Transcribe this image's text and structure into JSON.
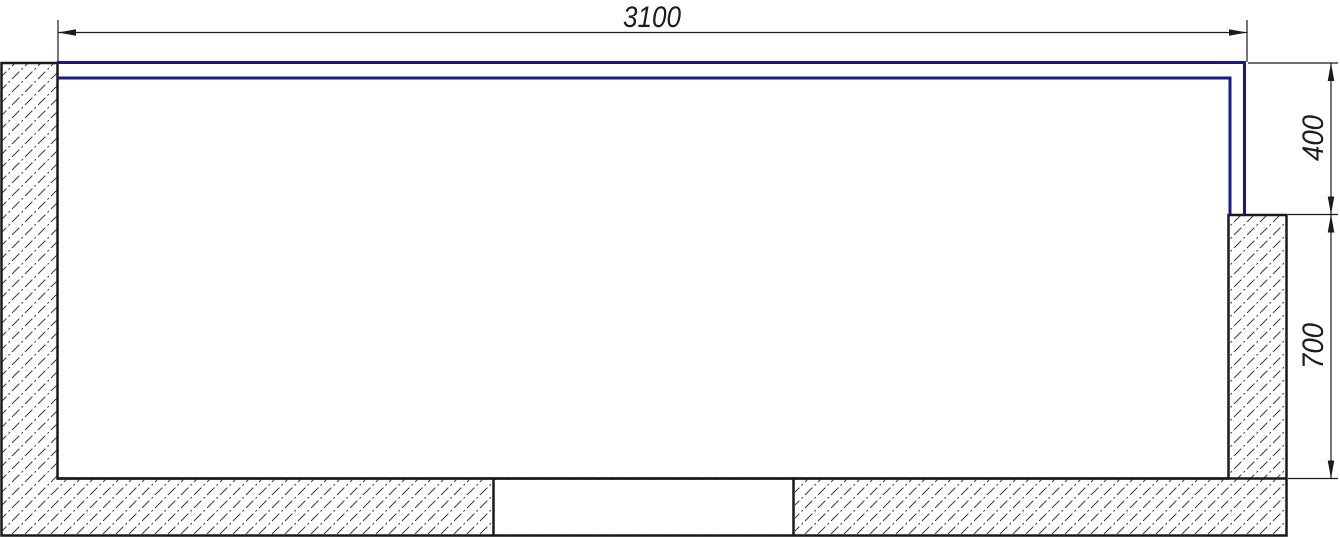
{
  "drawing": {
    "type": "technical-plan-section",
    "dimension_labels": {
      "width": "3100",
      "side_upper": "400",
      "side_lower": "700"
    },
    "colors": {
      "outline": "#1a1a1a",
      "profile_blue": "#17178f",
      "hatch_line": "#3a3a3a",
      "background": "#ffffff"
    }
  }
}
